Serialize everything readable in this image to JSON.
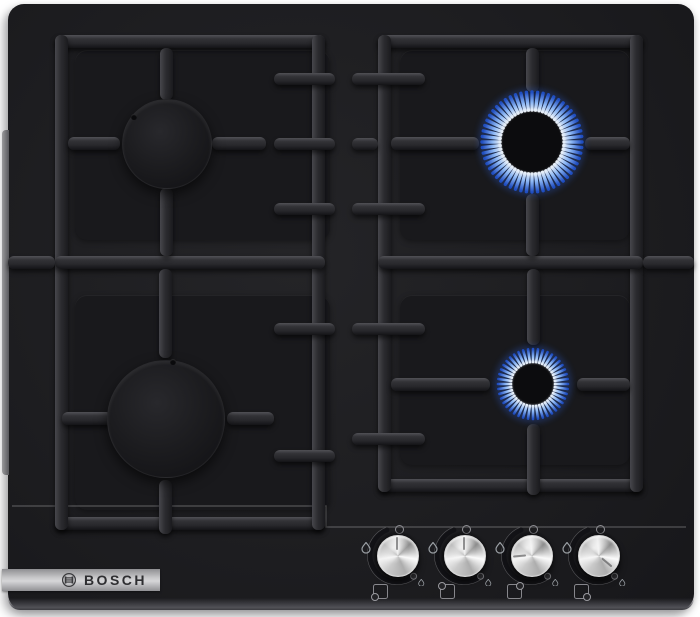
{
  "product": {
    "type": "gas-hob",
    "brand": "BOSCH",
    "surface": "black tempered glass",
    "burner_count": 4
  },
  "logo": {
    "text": "BOSCH",
    "emblem": "bosch-armature-icon"
  },
  "burners": [
    {
      "id": "back-left",
      "label": "back left burner",
      "size": "medium",
      "lit": false
    },
    {
      "id": "front-left",
      "label": "front left burner",
      "size": "large",
      "lit": false
    },
    {
      "id": "back-right",
      "label": "back right burner",
      "size": "medium",
      "lit": true
    },
    {
      "id": "front-right",
      "label": "front right burner",
      "size": "small",
      "lit": true
    }
  ],
  "knobs": [
    {
      "id": "knob-1",
      "controls": "front-left",
      "setting": "off",
      "marker": "0",
      "burner_icon_corner": "bottom-left",
      "icons": [
        "zero-position-icon",
        "large-flame-icon",
        "small-flame-icon",
        "burner-position-icon"
      ]
    },
    {
      "id": "knob-2",
      "controls": "back-left",
      "setting": "off",
      "marker": "0",
      "burner_icon_corner": "top-left",
      "icons": [
        "zero-position-icon",
        "large-flame-icon",
        "small-flame-icon",
        "burner-position-icon"
      ]
    },
    {
      "id": "knob-3",
      "controls": "back-right",
      "setting": "on-high",
      "marker": "0",
      "burner_icon_corner": "top-right",
      "icons": [
        "zero-position-icon",
        "large-flame-icon",
        "small-flame-icon",
        "burner-position-icon"
      ]
    },
    {
      "id": "knob-4",
      "controls": "front-right",
      "setting": "on-low",
      "marker": "0",
      "burner_icon_corner": "bottom-right",
      "icons": [
        "zero-position-icon",
        "large-flame-icon",
        "small-flame-icon",
        "burner-position-icon"
      ]
    }
  ],
  "colors": {
    "glass": "#1d1d1f",
    "grid_iron": "#2c2c30",
    "flame_core": "#ffffff",
    "flame_mid": "#96c2ff",
    "flame_tip": "#2050c8",
    "flame_glow": "#2a5cd0",
    "knob_metal": "#d9d9d9",
    "strip_silver": "#c8c8ca",
    "background": "#ffffff"
  }
}
